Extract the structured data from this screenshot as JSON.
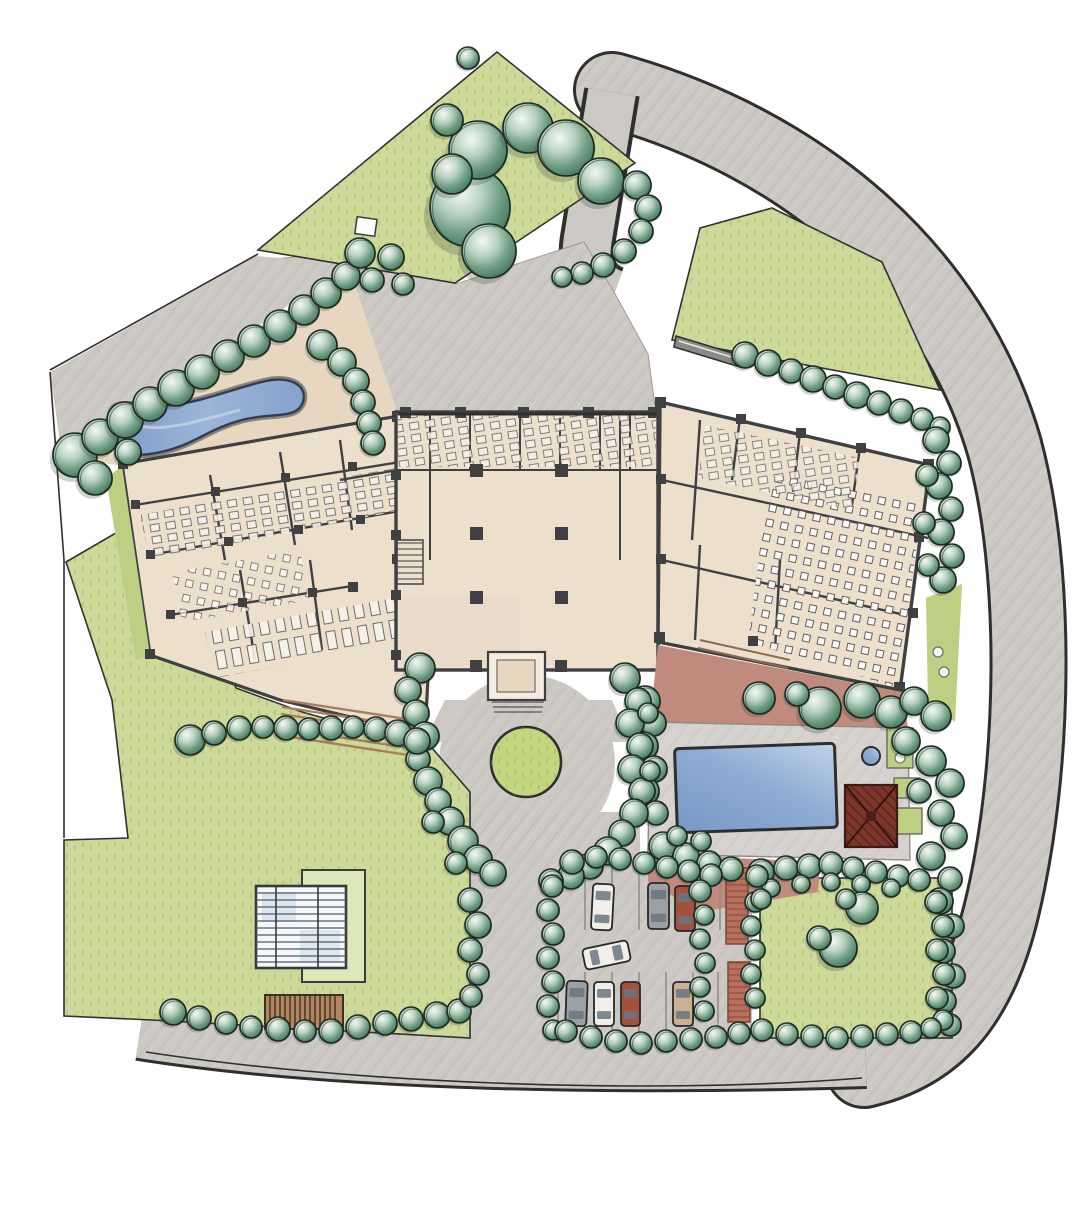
{
  "title": "Hand-drawn architectural site plan, watercolor style, top view of a resort campus with courtyard hotel, restaurant wing, spa pond, swimming pool, circular forecourt, parking lot, greenhouse and tree-lined lawns",
  "palette": {
    "paper": "#ffffff",
    "lawn": "#cdd999",
    "lawn_deep": "#bccf82",
    "grass_stroke": "#93ad55",
    "road": "#ccc8c4",
    "road_dark": "#b4b0ab",
    "tan": "#e7d7c1",
    "floor": "#ecdfcc",
    "wall": "#3f4042",
    "ink": "#2e2f2e",
    "water": "#8fa9cf",
    "water_light": "#c2d2e8",
    "terrace_red": "#c08a7c",
    "brick": "#b5705e",
    "roof_red": "#7c362b",
    "wood": "#b08663",
    "step_brown": "#a87f5e",
    "tree_dark": "#3a6b52",
    "tree_mid": "#6f9e83",
    "tree_light": "#b9d2c2",
    "tree_outline": "#1d2b22"
  },
  "scene": {
    "trees": [
      [
        75,
        455,
        22
      ],
      [
        100,
        437,
        18
      ],
      [
        125,
        420,
        18
      ],
      [
        150,
        404,
        17
      ],
      [
        176,
        388,
        18
      ],
      [
        202,
        372,
        17
      ],
      [
        228,
        356,
        16
      ],
      [
        254,
        341,
        16
      ],
      [
        280,
        326,
        16
      ],
      [
        304,
        310,
        15
      ],
      [
        326,
        293,
        15
      ],
      [
        346,
        276,
        14
      ],
      [
        95,
        478,
        17
      ],
      [
        128,
        452,
        13
      ],
      [
        360,
        253,
        15
      ],
      [
        391,
        257,
        13
      ],
      [
        372,
        280,
        12
      ],
      [
        403,
        284,
        11
      ],
      [
        322,
        345,
        15
      ],
      [
        342,
        362,
        14
      ],
      [
        356,
        381,
        13
      ],
      [
        363,
        402,
        12
      ],
      [
        369,
        423,
        12
      ],
      [
        373,
        443,
        12
      ],
      [
        470,
        207,
        40
      ],
      [
        478,
        150,
        29
      ],
      [
        528,
        128,
        25
      ],
      [
        566,
        148,
        28
      ],
      [
        601,
        181,
        23
      ],
      [
        489,
        251,
        27
      ],
      [
        452,
        174,
        20
      ],
      [
        468,
        58,
        11
      ],
      [
        447,
        120,
        16
      ],
      [
        637,
        185,
        14
      ],
      [
        648,
        208,
        13
      ],
      [
        641,
        231,
        12
      ],
      [
        624,
        251,
        12
      ],
      [
        603,
        265,
        12
      ],
      [
        582,
        273,
        11
      ],
      [
        562,
        277,
        10
      ],
      [
        745,
        355,
        13
      ],
      [
        768,
        363,
        13
      ],
      [
        791,
        371,
        12
      ],
      [
        813,
        379,
        13
      ],
      [
        835,
        387,
        12
      ],
      [
        857,
        395,
        13
      ],
      [
        879,
        403,
        12
      ],
      [
        901,
        411,
        12
      ],
      [
        922,
        419,
        11
      ],
      [
        940,
        427,
        10
      ],
      [
        936,
        440,
        13
      ],
      [
        949,
        463,
        12
      ],
      [
        939,
        486,
        13
      ],
      [
        951,
        509,
        12
      ],
      [
        941,
        532,
        13
      ],
      [
        952,
        556,
        12
      ],
      [
        943,
        580,
        13
      ],
      [
        927,
        475,
        11
      ],
      [
        924,
        523,
        11
      ],
      [
        928,
        565,
        11
      ],
      [
        862,
        700,
        18
      ],
      [
        891,
        712,
        16
      ],
      [
        914,
        701,
        14
      ],
      [
        936,
        716,
        15
      ],
      [
        906,
        741,
        14
      ],
      [
        931,
        761,
        15
      ],
      [
        950,
        783,
        14
      ],
      [
        919,
        791,
        12
      ],
      [
        941,
        813,
        13
      ],
      [
        954,
        836,
        13
      ],
      [
        931,
        856,
        14
      ],
      [
        950,
        879,
        12
      ],
      [
        940,
        901,
        13
      ],
      [
        952,
        926,
        12
      ],
      [
        943,
        951,
        12
      ],
      [
        953,
        976,
        12
      ],
      [
        944,
        1001,
        12
      ],
      [
        950,
        1025,
        11
      ],
      [
        761,
        872,
        13
      ],
      [
        786,
        868,
        12
      ],
      [
        809,
        866,
        12
      ],
      [
        831,
        864,
        12
      ],
      [
        853,
        868,
        11
      ],
      [
        876,
        872,
        11
      ],
      [
        898,
        876,
        11
      ],
      [
        919,
        880,
        11
      ],
      [
        771,
        888,
        9
      ],
      [
        801,
        884,
        9
      ],
      [
        831,
        882,
        9
      ],
      [
        861,
        884,
        9
      ],
      [
        891,
        888,
        9
      ],
      [
        936,
        902,
        11
      ],
      [
        943,
        926,
        11
      ],
      [
        937,
        950,
        11
      ],
      [
        944,
        974,
        11
      ],
      [
        937,
        998,
        11
      ],
      [
        943,
        1020,
        10
      ],
      [
        762,
        1030,
        11
      ],
      [
        787,
        1034,
        11
      ],
      [
        812,
        1036,
        11
      ],
      [
        837,
        1038,
        11
      ],
      [
        862,
        1036,
        11
      ],
      [
        887,
        1034,
        11
      ],
      [
        911,
        1032,
        11
      ],
      [
        931,
        1028,
        10
      ],
      [
        755,
        902,
        10
      ],
      [
        751,
        926,
        10
      ],
      [
        755,
        950,
        10
      ],
      [
        751,
        974,
        10
      ],
      [
        755,
        998,
        10
      ],
      [
        838,
        948,
        19
      ],
      [
        819,
        938,
        12
      ],
      [
        862,
        908,
        16
      ],
      [
        846,
        899,
        10
      ],
      [
        645,
        701,
        15
      ],
      [
        653,
        723,
        13
      ],
      [
        644,
        746,
        14
      ],
      [
        654,
        769,
        13
      ],
      [
        645,
        791,
        14
      ],
      [
        656,
        813,
        12
      ],
      [
        663,
        846,
        14
      ],
      [
        686,
        856,
        13
      ],
      [
        709,
        863,
        12
      ],
      [
        731,
        869,
        12
      ],
      [
        701,
        841,
        10
      ],
      [
        677,
        836,
        10
      ],
      [
        759,
        698,
        16
      ],
      [
        820,
        708,
        21
      ],
      [
        797,
        694,
        12
      ],
      [
        420,
        668,
        15
      ],
      [
        408,
        690,
        13
      ],
      [
        416,
        713,
        13
      ],
      [
        425,
        736,
        14
      ],
      [
        418,
        759,
        12
      ],
      [
        428,
        781,
        14
      ],
      [
        438,
        801,
        13
      ],
      [
        450,
        821,
        14
      ],
      [
        463,
        841,
        15
      ],
      [
        478,
        859,
        14
      ],
      [
        493,
        873,
        13
      ],
      [
        433,
        822,
        11
      ],
      [
        456,
        863,
        11
      ],
      [
        625,
        678,
        15
      ],
      [
        638,
        701,
        13
      ],
      [
        630,
        723,
        14
      ],
      [
        640,
        746,
        13
      ],
      [
        632,
        769,
        14
      ],
      [
        642,
        791,
        13
      ],
      [
        634,
        813,
        14
      ],
      [
        622,
        833,
        13
      ],
      [
        608,
        851,
        14
      ],
      [
        590,
        866,
        13
      ],
      [
        571,
        876,
        13
      ],
      [
        551,
        881,
        12
      ],
      [
        648,
        713,
        10
      ],
      [
        650,
        771,
        10
      ],
      [
        572,
        862,
        12
      ],
      [
        596,
        857,
        11
      ],
      [
        620,
        859,
        11
      ],
      [
        644,
        863,
        11
      ],
      [
        667,
        867,
        11
      ],
      [
        689,
        871,
        11
      ],
      [
        711,
        875,
        11
      ],
      [
        552,
        886,
        11
      ],
      [
        548,
        910,
        11
      ],
      [
        553,
        934,
        11
      ],
      [
        548,
        958,
        11
      ],
      [
        553,
        982,
        11
      ],
      [
        548,
        1006,
        11
      ],
      [
        553,
        1030,
        10
      ],
      [
        700,
        891,
        11
      ],
      [
        704,
        915,
        10
      ],
      [
        700,
        939,
        10
      ],
      [
        705,
        963,
        10
      ],
      [
        700,
        987,
        10
      ],
      [
        704,
        1011,
        10
      ],
      [
        566,
        1031,
        11
      ],
      [
        591,
        1037,
        11
      ],
      [
        616,
        1041,
        11
      ],
      [
        641,
        1043,
        11
      ],
      [
        666,
        1041,
        11
      ],
      [
        691,
        1039,
        11
      ],
      [
        716,
        1037,
        11
      ],
      [
        739,
        1033,
        11
      ],
      [
        757,
        876,
        11
      ],
      [
        761,
        899,
        10
      ],
      [
        190,
        740,
        15
      ],
      [
        214,
        733,
        12
      ],
      [
        239,
        728,
        12
      ],
      [
        263,
        727,
        11
      ],
      [
        286,
        728,
        12
      ],
      [
        309,
        729,
        11
      ],
      [
        331,
        728,
        12
      ],
      [
        353,
        727,
        11
      ],
      [
        376,
        729,
        12
      ],
      [
        398,
        733,
        13
      ],
      [
        417,
        741,
        13
      ],
      [
        173,
        1012,
        13
      ],
      [
        199,
        1018,
        12
      ],
      [
        226,
        1023,
        11
      ],
      [
        251,
        1027,
        11
      ],
      [
        278,
        1029,
        12
      ],
      [
        305,
        1031,
        11
      ],
      [
        331,
        1031,
        12
      ],
      [
        358,
        1027,
        12
      ],
      [
        385,
        1023,
        12
      ],
      [
        411,
        1019,
        12
      ],
      [
        437,
        1015,
        13
      ],
      [
        459,
        1011,
        12
      ],
      [
        470,
        900,
        12
      ],
      [
        478,
        925,
        13
      ],
      [
        470,
        950,
        12
      ],
      [
        478,
        974,
        11
      ],
      [
        471,
        996,
        11
      ]
    ],
    "cars": [
      {
        "x": 592,
        "y": 884,
        "w": 21,
        "h": 46,
        "a": 3,
        "c": "white"
      },
      {
        "x": 648,
        "y": 883,
        "w": 21,
        "h": 46,
        "a": 0,
        "c": "gray"
      },
      {
        "x": 675,
        "y": 886,
        "w": 20,
        "h": 45,
        "a": 0,
        "c": "red"
      },
      {
        "x": 596,
        "y": 932,
        "w": 21,
        "h": 46,
        "a": 78,
        "c": "white"
      },
      {
        "x": 566,
        "y": 981,
        "w": 21,
        "h": 45,
        "a": 2,
        "c": "gray"
      },
      {
        "x": 594,
        "y": 982,
        "w": 20,
        "h": 44,
        "a": 0,
        "c": "white"
      },
      {
        "x": 621,
        "y": 982,
        "w": 19,
        "h": 44,
        "a": 0,
        "c": "red"
      },
      {
        "x": 673,
        "y": 982,
        "w": 20,
        "h": 44,
        "a": 0,
        "c": "tan"
      }
    ],
    "car_colors": {
      "white": "#f1efe9",
      "gray": "#9aa0a3",
      "red": "#a0523d",
      "tan": "#c9b292"
    },
    "features": {
      "pond": "organic kidney-shaped reflecting pond",
      "pool": "rectangular swimming pool",
      "spa": "small round spa",
      "pavilion": "red hip-roof pool pavilion",
      "greenhouse": "glass-roofed garden house",
      "pergola": "wood slat pergola",
      "forecourt_island": "round planted island in circular driveway"
    }
  }
}
